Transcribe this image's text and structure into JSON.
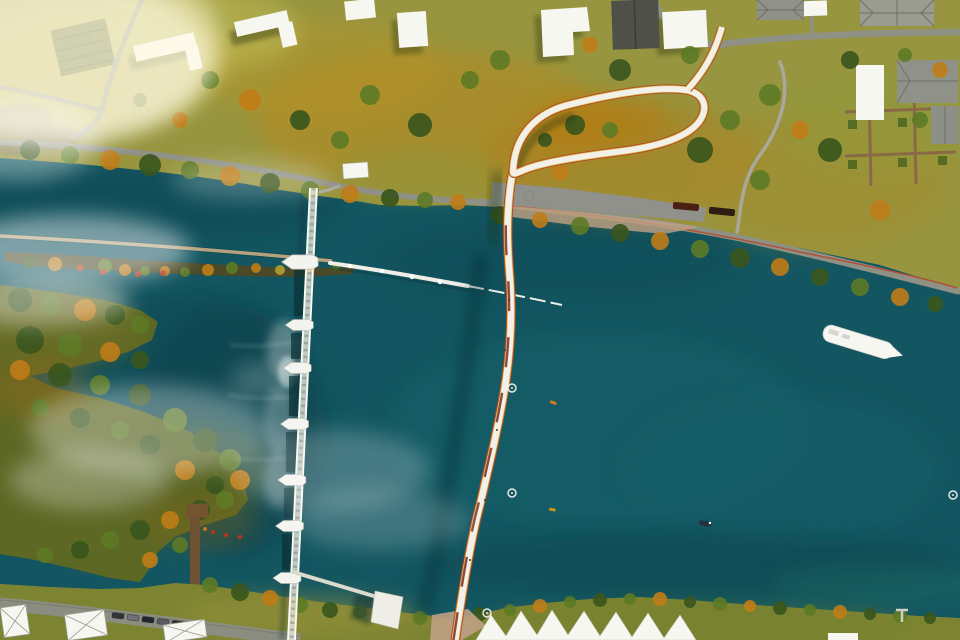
{
  "meta": {
    "type": "aerial-architectural-rendering",
    "subject": "Top-down rendering of a curved pedestrian bridge with a spiral approach loop crossing a teal river next to a weir dam",
    "text_visible": "none"
  },
  "colors": {
    "water_base": "#135661",
    "water_dark": "#0b3f4b",
    "water_light": "#1c666d",
    "land_north": "#97953f",
    "land_sw": "#5c6824",
    "land_south": "#7d8431",
    "meadow_orange": "#b5851f",
    "field_yellow": "#c9c063",
    "road_grey": "#8f9184",
    "deck_white": "#f2f0e8",
    "stripe_red": "#b6452c",
    "stripe_yellow": "#d9c14a",
    "deck_red_segment": "#7e2a1c",
    "truss_white": "#e9e7db",
    "building_white": "#f7f7f2",
    "roof_grey": "#90928a",
    "tree_dark": "#3a561d",
    "tree_orange": "#c07c17",
    "tree_red": "#b23a1a",
    "fog_white": "#ffffff",
    "tan_plaza": "#bfa184",
    "dock_brown": "#75552f"
  },
  "scene": {
    "river": {
      "label": "river with two channels"
    },
    "island": {
      "label": "narrow breakwater island with autumn trees"
    },
    "bridge": {
      "label": "curved pedestrian bridge",
      "loop": "teardrop approach loop on north bank"
    },
    "dam": {
      "label": "weir with truss service bridge",
      "pier_count": 7
    },
    "boom": {
      "label": "floating boom walkway downstream of weir"
    },
    "boat": {
      "label": "white passenger boat",
      "count": 1
    },
    "buoys": {
      "count": 4
    },
    "kayaks": {
      "count": 2
    },
    "rowboat": {
      "count": 1
    },
    "parked_cars": {
      "count": 6
    },
    "pavilions": {
      "label": "white peaked pavilion roofs on south bank"
    },
    "dock": {
      "label": "wooden jetty on southwest shore"
    },
    "fog": {
      "label": "morning mist over water and fields"
    }
  }
}
